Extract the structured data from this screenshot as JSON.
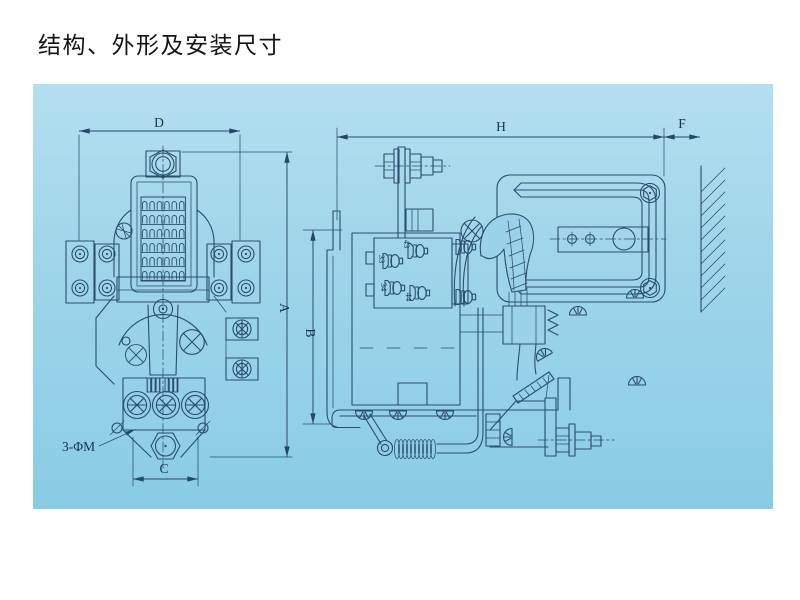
{
  "title": "结构、外形及安装尺寸",
  "colors": {
    "page_background": "#ffffff",
    "panel_blue": "#9ed5e9",
    "drawing_line": "#2b4d6e",
    "title_text": "#141414"
  },
  "drawing": {
    "front_view": {
      "dims": {
        "width_top": "D",
        "height_right": "A",
        "width_bottom": "C"
      },
      "mounting_note": "3-ΦM"
    },
    "side_view": {
      "dims": {
        "width_top": "H",
        "depth_right": "F",
        "height_left": "B"
      },
      "aux_terminals": [
        "43",
        "33",
        "34",
        "44"
      ]
    }
  }
}
